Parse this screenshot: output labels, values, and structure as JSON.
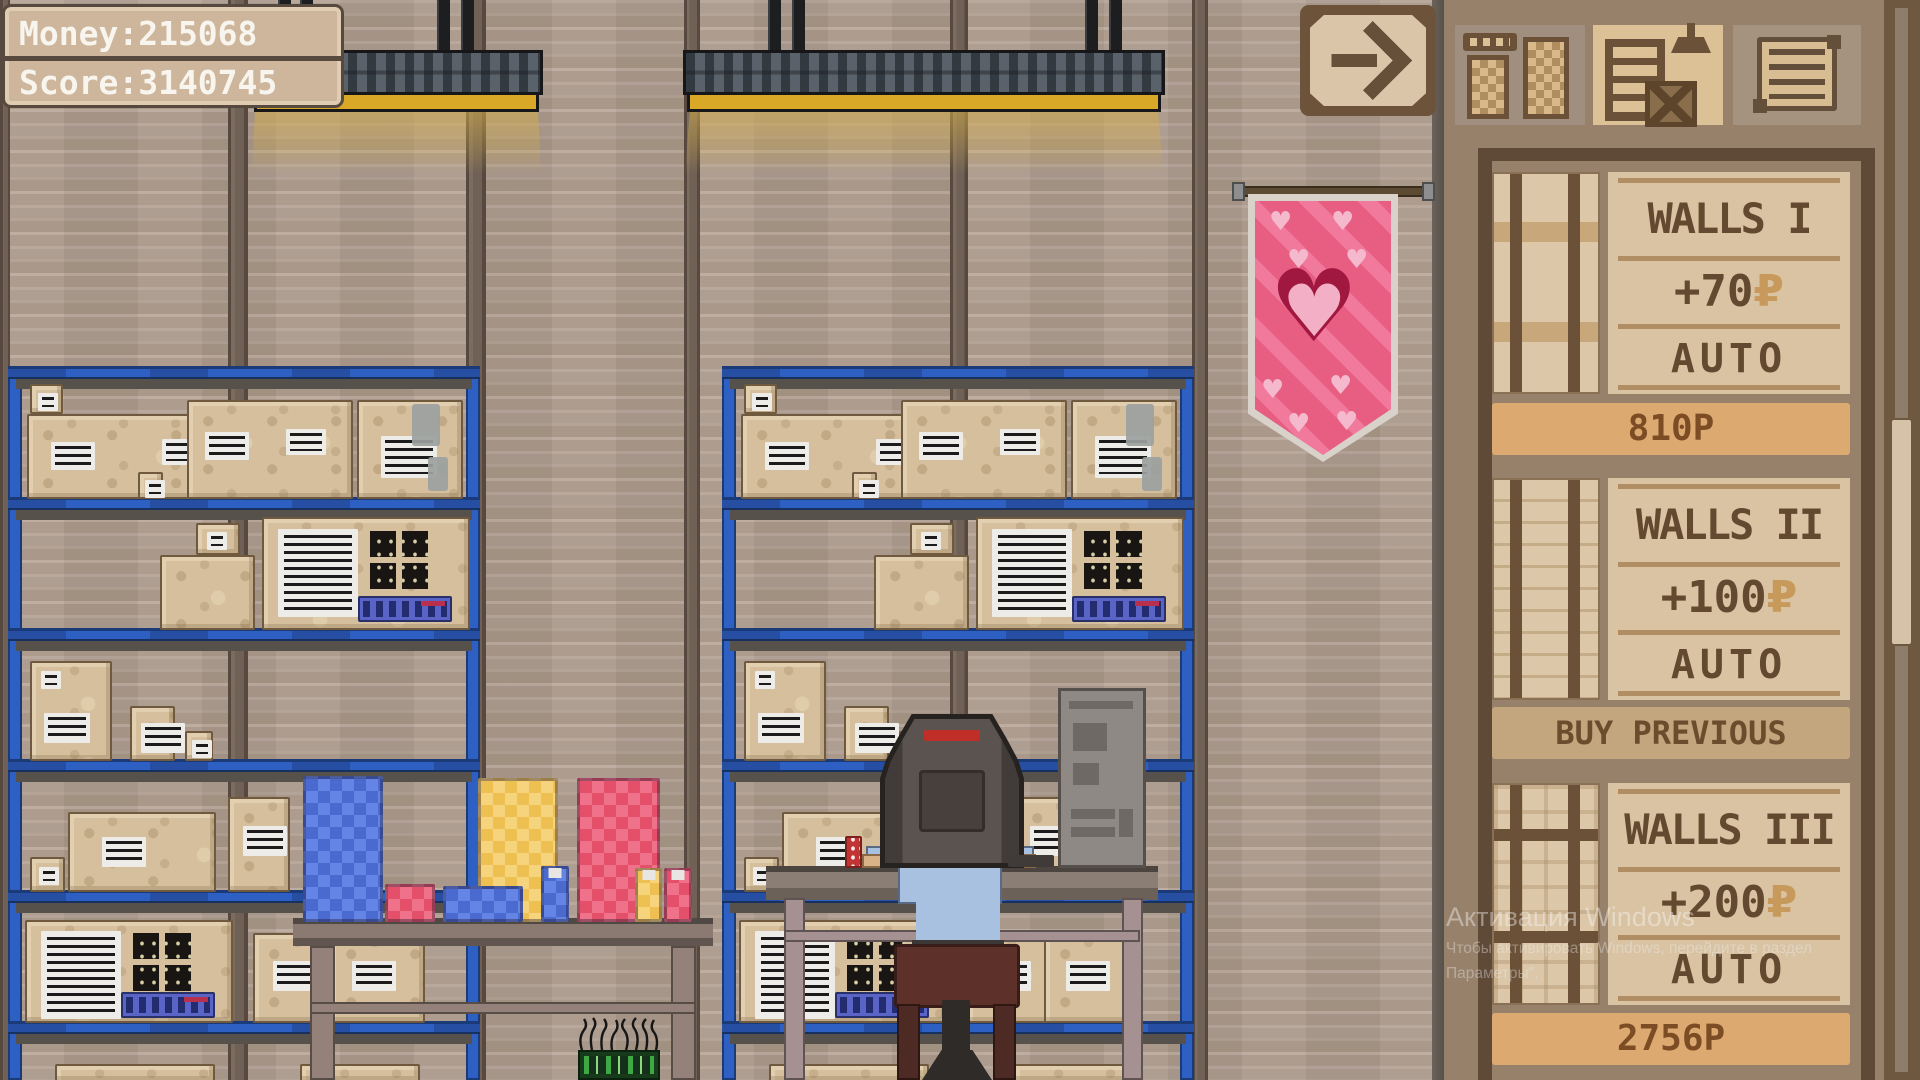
{
  "hud": {
    "money": "Money:215068",
    "score": "Score:3140745"
  },
  "nav": {
    "arrow_icon": "arrow-right-icon"
  },
  "tabs": [
    {
      "id": "furniture",
      "icon": "wardrobe-icon",
      "selected": false
    },
    {
      "id": "storage",
      "icon": "shelf-crate-lamp-icon",
      "selected": true
    },
    {
      "id": "orders",
      "icon": "scroll-icon",
      "selected": false
    }
  ],
  "shop": {
    "items": [
      {
        "title": "WALLS I",
        "bonus": "+70",
        "currency": "₽",
        "mode": "AUTO",
        "footer": "810P"
      },
      {
        "title": "WALLS II",
        "bonus": "+100",
        "currency": "₽",
        "mode": "AUTO",
        "footer": "BUY PREVIOUS"
      },
      {
        "title": "WALLS III",
        "bonus": "+200",
        "currency": "₽",
        "mode": "AUTO",
        "footer": "2756P"
      }
    ]
  },
  "watermark": {
    "line1": "Активация Windows",
    "line2": "Чтобы активировать Windows, перейдите в раздел",
    "line3": "Параметры\"."
  },
  "colors": {
    "shelf_blue": "#2e5fc2",
    "banner_pink": "#e85d82",
    "panel_brown": "#97816b",
    "card_paper": "#d9c3a3",
    "price_bar": "#dcaa70",
    "lamp_yellow": "#d8a826",
    "box_cardboard": "#d5bf9c",
    "hud_text": "#f8f5ef"
  },
  "scene": {
    "wall": {
      "pillars": [
        {
          "x": 0,
          "w": 10
        },
        {
          "x": 228,
          "w": 20
        },
        {
          "x": 466,
          "w": 20
        },
        {
          "x": 684,
          "w": 16
        },
        {
          "x": 950,
          "w": 18
        },
        {
          "x": 1192,
          "w": 16
        }
      ]
    },
    "lamps": [
      {
        "x": 250,
        "w": 293,
        "posts": [
          278,
          300,
          437,
          461
        ]
      },
      {
        "x": 683,
        "w": 482,
        "posts": [
          768,
          792,
          1085,
          1109
        ]
      }
    ],
    "shelves": [
      {
        "x": 8,
        "w": 472,
        "top": 366,
        "rows": [
          {
            "floor": 497,
            "boxes": [
              [
                27,
                226,
                85,
                "m2"
              ],
              [
                30,
                33,
                30,
                "s",
                412
              ],
              [
                138,
                25,
                27,
                "s"
              ],
              [
                187,
                166,
                99,
                "m2"
              ],
              [
                357,
                106,
                99,
                "t"
              ]
            ]
          },
          {
            "floor": 628,
            "boxes": [
              [
                160,
                95,
                75,
                "p"
              ],
              [
                196,
                44,
                32,
                "s",
                553
              ],
              [
                262,
                208,
                113,
                "q"
              ]
            ]
          },
          {
            "floor": 759,
            "boxes": [
              [
                30,
                82,
                100,
                "m2s"
              ],
              [
                130,
                45,
                55,
                "m"
              ],
              [
                185,
                28,
                30,
                "s"
              ]
            ]
          },
          {
            "floor": 890,
            "boxes": [
              [
                30,
                35,
                35,
                "s"
              ],
              [
                68,
                148,
                80,
                "m"
              ],
              [
                228,
                62,
                95,
                "m"
              ]
            ]
          },
          {
            "floor": 1021,
            "boxes": [
              [
                25,
                208,
                103,
                "q"
              ],
              [
                253,
                85,
                90,
                "m"
              ],
              [
                330,
                95,
                90,
                "m"
              ]
            ]
          },
          {
            "floor": 1080,
            "boxes": [
              [
                55,
                160,
                18,
                "p"
              ],
              [
                300,
                120,
                18,
                "p"
              ]
            ]
          }
        ]
      },
      {
        "x": 722,
        "w": 472,
        "top": 366,
        "rows": [
          {
            "floor": 497,
            "boxes": [
              [
                741,
                226,
                85,
                "m2"
              ],
              [
                744,
                33,
                30,
                "s",
                412
              ],
              [
                852,
                25,
                27,
                "s"
              ],
              [
                901,
                166,
                99,
                "m2"
              ],
              [
                1071,
                106,
                99,
                "t"
              ]
            ]
          },
          {
            "floor": 628,
            "boxes": [
              [
                874,
                95,
                75,
                "p"
              ],
              [
                910,
                44,
                32,
                "s",
                553
              ],
              [
                976,
                208,
                113,
                "q"
              ]
            ]
          },
          {
            "floor": 759,
            "boxes": [
              [
                744,
                82,
                100,
                "m2s"
              ],
              [
                844,
                45,
                55,
                "m"
              ],
              [
                899,
                28,
                30,
                "s"
              ]
            ]
          },
          {
            "floor": 890,
            "boxes": [
              [
                744,
                35,
                35,
                "s"
              ],
              [
                782,
                148,
                80,
                "m"
              ],
              [
                1016,
                58,
                95,
                "m"
              ]
            ]
          },
          {
            "floor": 1021,
            "boxes": [
              [
                739,
                208,
                103,
                "q"
              ],
              [
                967,
                85,
                90,
                "m"
              ],
              [
                1044,
                95,
                90,
                "m"
              ]
            ]
          },
          {
            "floor": 1080,
            "boxes": [
              [
                769,
                160,
                18,
                "p"
              ],
              [
                1014,
                120,
                18,
                "p"
              ]
            ]
          }
        ]
      }
    ],
    "rolls": [
      {
        "x": 303,
        "w": 80,
        "h": 146,
        "color": "blue"
      },
      {
        "x": 478,
        "w": 80,
        "h": 144,
        "color": "yellow"
      },
      {
        "x": 577,
        "w": 83,
        "h": 144,
        "color": "red"
      },
      {
        "x": 385,
        "w": 50,
        "h": 38,
        "color": "red"
      },
      {
        "x": 443,
        "w": 80,
        "h": 36,
        "color": "blue"
      },
      {
        "x": 541,
        "w": 28,
        "h": 56,
        "color": "blue",
        "tag": true
      },
      {
        "x": 635,
        "w": 27,
        "h": 54,
        "color": "yellow",
        "tag": true
      },
      {
        "x": 664,
        "w": 28,
        "h": 54,
        "color": "red",
        "tag": true
      }
    ]
  }
}
